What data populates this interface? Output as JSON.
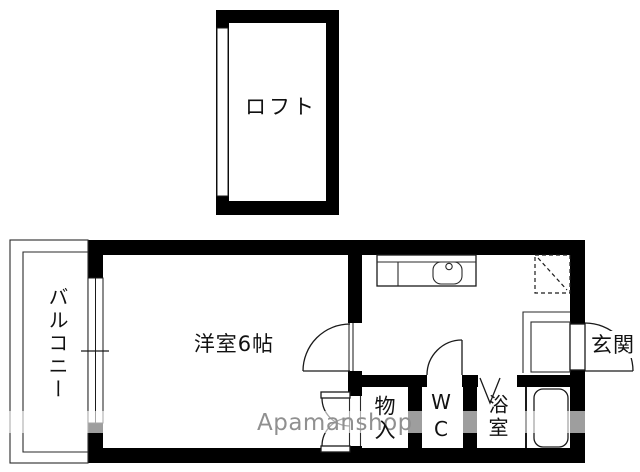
{
  "floorplan": {
    "rooms": {
      "loft": "ロフト",
      "bedroom": "洋室6帖",
      "balcony": "バルコニー",
      "storage": "物入",
      "wc": "WC",
      "bath": "浴室",
      "entrance": "玄関"
    },
    "watermark": "Apamanshop",
    "colors": {
      "wall": "#000000",
      "floor": "#ffffff",
      "watermark_gray": "#909090"
    }
  }
}
